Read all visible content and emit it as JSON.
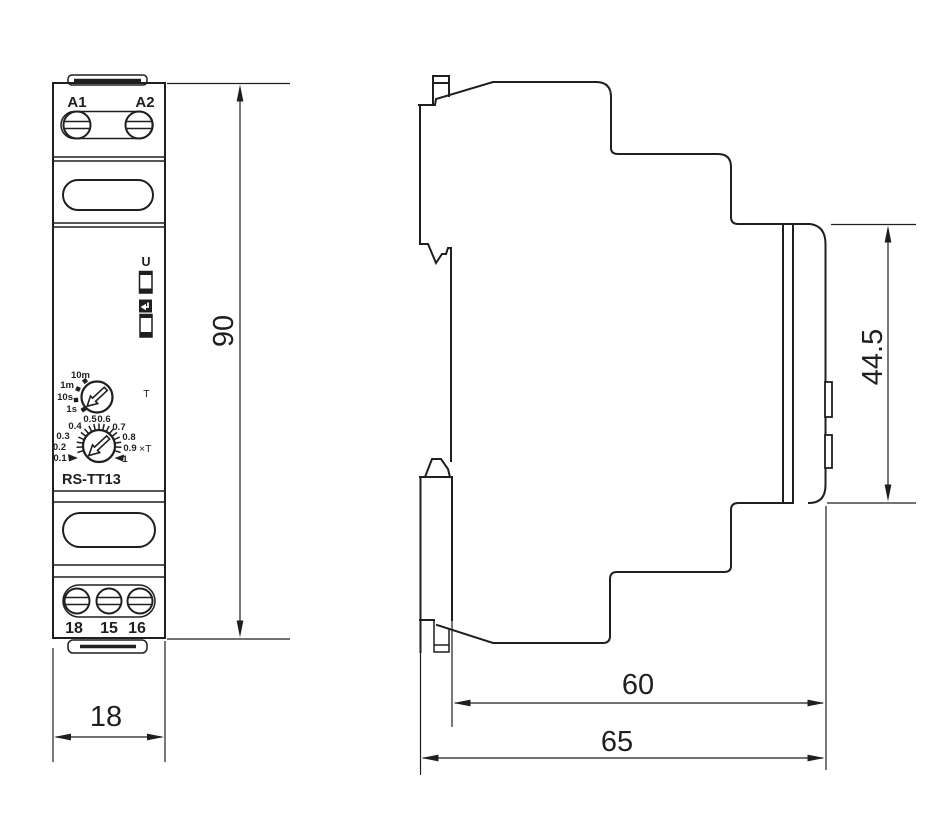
{
  "drawing": {
    "front_view": {
      "terminal_top_labels": [
        "A1",
        "A2"
      ],
      "power_indicator_label": "U",
      "time_dial_labels": [
        "10m",
        "1m",
        "10s",
        "1s"
      ],
      "time_dial_unit_label": "T",
      "multiplier_dial_labels": [
        "0.1",
        "0.2",
        "0.3",
        "0.4",
        "0.5",
        "0.6",
        "0.7",
        "0.8",
        "0.9",
        "1"
      ],
      "multiplier_unit_label": "×T",
      "model_label": "RS-TT13",
      "terminal_bottom_labels": [
        "18",
        "15",
        "16"
      ]
    },
    "dimensions": {
      "height_mm": "90",
      "width_mm": "18",
      "front_panel_height_mm": "44.5",
      "body_depth_mm": "60",
      "total_depth_mm": "65"
    },
    "colors": {
      "line": "#1f1f1f",
      "background": "#ffffff"
    }
  }
}
